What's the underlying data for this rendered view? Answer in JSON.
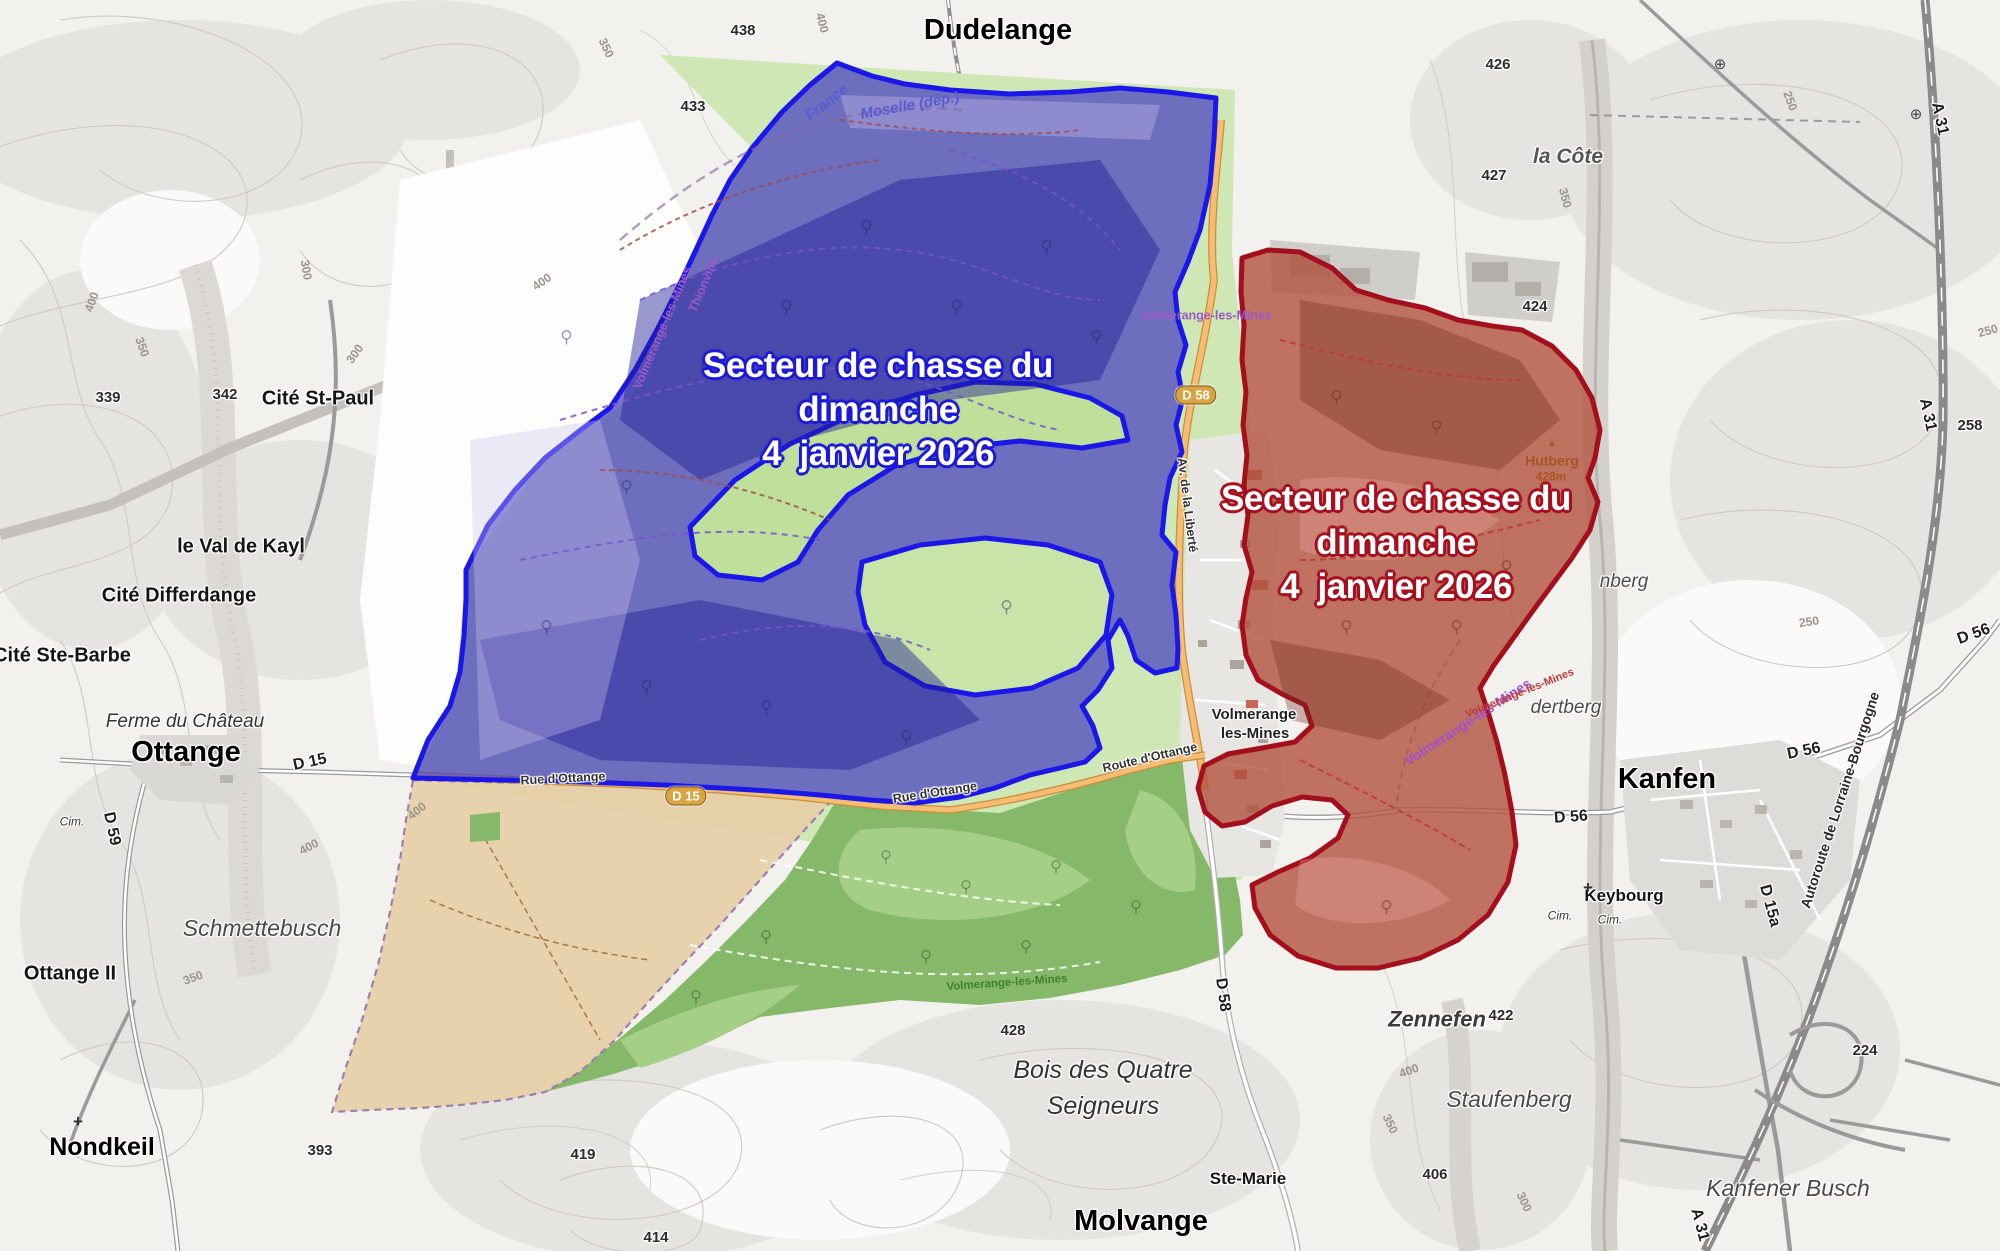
{
  "map_overlays": {
    "blue_sector": {
      "line1": "Secteur de chasse du",
      "line2": "dimanche",
      "line3": "4  janvier 2026",
      "outline_color": "#1d1ad6"
    },
    "red_sector": {
      "line1": "Secteur de chasse du",
      "line2": "dimanche",
      "line3": "4  janvier 2026",
      "outline_color": "#a50f1e"
    }
  },
  "zones": {
    "blue": {
      "fill": "#4a44c0",
      "border": "#1a17e8"
    },
    "red": {
      "fill": "#b2604f",
      "border": "#a30f1c"
    },
    "tan": {
      "fill": "#e7cfa9",
      "border": "#9b7fae"
    }
  },
  "map": {
    "labels": [
      {
        "text": "Dudelange",
        "x": 998,
        "y": 30,
        "kind": "town-xl halo",
        "name": "label-dudelange"
      },
      {
        "text": "Ottange",
        "x": 186,
        "y": 752,
        "kind": "town-xl halo",
        "name": "label-ottange"
      },
      {
        "text": "Molvange",
        "x": 1141,
        "y": 1221,
        "kind": "town-xl halo",
        "name": "label-molvange"
      },
      {
        "text": "Kanfen",
        "x": 1667,
        "y": 779,
        "kind": "town-xl halo",
        "name": "label-kanfen"
      },
      {
        "text": "Nondkeil",
        "x": 102,
        "y": 1147,
        "kind": "town-lg halo",
        "name": "label-nondkeil"
      },
      {
        "text": "Zennefen",
        "x": 1437,
        "y": 1019,
        "kind": "wood-b halo",
        "name": "label-zennefen"
      },
      {
        "text": "Volmerange",
        "x": 1254,
        "y": 715,
        "kind": "town-2l halo",
        "name": "label-volmerange-line1"
      },
      {
        "text": "les-Mines",
        "x": 1255,
        "y": 734,
        "kind": "town-2l halo",
        "name": "label-volmerange-line2"
      },
      {
        "text": "Cité St-Paul",
        "x": 318,
        "y": 399,
        "kind": "town-md halo",
        "name": "label-cite-st-paul"
      },
      {
        "text": "le Val de Kayl",
        "x": 241,
        "y": 547,
        "kind": "town-md halo",
        "name": "label-le-val-de-kayl"
      },
      {
        "text": "Cité Differdange",
        "x": 179,
        "y": 596,
        "kind": "town-md halo",
        "name": "label-cite-differdange"
      },
      {
        "text": "Cité Ste-Barbe",
        "x": 62,
        "y": 656,
        "kind": "town-md halo",
        "name": "label-cite-ste-barbe"
      },
      {
        "text": "Ottange II",
        "x": 70,
        "y": 974,
        "kind": "town-md halo",
        "name": "label-ottange-2"
      },
      {
        "text": "Ste-Marie",
        "x": 1248,
        "y": 1179,
        "kind": "town-sm halo",
        "name": "label-ste-marie"
      },
      {
        "text": "Keybourg",
        "x": 1624,
        "y": 896,
        "kind": "town-sm halo",
        "name": "label-keybourg"
      },
      {
        "text": "Ferme du Château",
        "x": 185,
        "y": 722,
        "kind": "farm halo",
        "name": "label-ferme-du-chateau"
      },
      {
        "text": "Schmettebusch",
        "x": 262,
        "y": 928,
        "kind": "wood halo",
        "name": "label-schmettebusch"
      },
      {
        "text": "Staufenberg",
        "x": 1509,
        "y": 1099,
        "kind": "wood halo",
        "name": "label-staufenberg"
      },
      {
        "text": "Kanfener Busch",
        "x": 1788,
        "y": 1188,
        "kind": "wood halo",
        "name": "label-kanfener-busch"
      },
      {
        "text": "Bois des Quatre",
        "x": 1103,
        "y": 1070,
        "kind": "wood-dk halo",
        "name": "label-bois-des-quatre"
      },
      {
        "text": "Seigneurs",
        "x": 1103,
        "y": 1106,
        "kind": "wood-dk halo",
        "name": "label-seigneurs"
      },
      {
        "text": "la Côte",
        "x": 1568,
        "y": 157,
        "kind": "hill halo",
        "name": "label-la-cote"
      },
      {
        "text": "dertberg",
        "x": 1566,
        "y": 708,
        "kind": "hill-sm halo",
        "name": "label-dertberg"
      },
      {
        "text": "nberg",
        "x": 1624,
        "y": 582,
        "kind": "hill-sm halo",
        "name": "label-nberg"
      },
      {
        "text": "Cim.",
        "x": 72,
        "y": 822,
        "kind": "cim halo",
        "name": "label-cimetiere"
      },
      {
        "text": "Cim.",
        "x": 1560,
        "y": 916,
        "kind": "cim halo",
        "name": "label-cimetiere"
      },
      {
        "text": "Cim.",
        "x": 1610,
        "y": 920,
        "kind": "cim halo",
        "name": "label-cimetiere"
      },
      {
        "text": "+",
        "x": 78,
        "y": 1122,
        "kind": "cross",
        "name": "cross-icon"
      },
      {
        "text": "+",
        "x": 1588,
        "y": 888,
        "kind": "cross",
        "name": "cross-icon"
      },
      {
        "text": "⊕",
        "x": 1720,
        "y": 65,
        "kind": "junction",
        "name": "junction-icon"
      },
      {
        "text": "⊕",
        "x": 1916,
        "y": 115,
        "kind": "junction",
        "name": "junction-icon"
      },
      {
        "text": "D 15",
        "x": 310,
        "y": 763,
        "rot": -12,
        "kind": "roadlbl halo",
        "name": "label-road-d15"
      },
      {
        "text": "D 59",
        "x": 111,
        "y": 829,
        "rot": 78,
        "kind": "roadlbl halo",
        "name": "label-road-d59"
      },
      {
        "text": "D 56",
        "x": 1571,
        "y": 818,
        "rot": -4,
        "kind": "roadlbl halo",
        "name": "label-road-d56"
      },
      {
        "text": "D 56",
        "x": 1804,
        "y": 752,
        "rot": -12,
        "kind": "roadlbl halo",
        "name": "label-road-d56"
      },
      {
        "text": "D 56",
        "x": 1974,
        "y": 635,
        "rot": -20,
        "kind": "roadlbl halo",
        "name": "label-road-d56"
      },
      {
        "text": "D 58",
        "x": 1222,
        "y": 995,
        "rot": 82,
        "kind": "roadlbl halo",
        "name": "label-road-d58"
      },
      {
        "text": "D 15a",
        "x": 1769,
        "y": 906,
        "rot": 75,
        "kind": "roadlbl halo",
        "name": "label-road-d15a"
      },
      {
        "text": "A 31",
        "x": 1939,
        "y": 119,
        "rot": 78,
        "kind": "roadlbl halo",
        "name": "label-road-a31"
      },
      {
        "text": "A 31",
        "x": 1927,
        "y": 415,
        "rot": 78,
        "kind": "roadlbl halo",
        "name": "label-road-a31"
      },
      {
        "text": "A 31",
        "x": 1699,
        "y": 1225,
        "rot": 75,
        "kind": "roadlbl halo",
        "name": "label-road-a31"
      },
      {
        "text": "258",
        "x": 1970,
        "y": 426,
        "kind": "elev halo",
        "name": "label-elev-258"
      },
      {
        "text": "224",
        "x": 1865,
        "y": 1051,
        "kind": "elev halo",
        "name": "label-elev-224"
      },
      {
        "text": "Autoroute de Lorraine-Bourgogne",
        "x": 1840,
        "y": 800,
        "rot": -72,
        "kind": "mwy halo",
        "name": "label-autoroute-lorraine-bourgogne"
      },
      {
        "text": "Route d'Ottange",
        "x": 1150,
        "y": 758,
        "rot": -13,
        "kind": "street halo",
        "name": "label-route-d-ottange"
      },
      {
        "text": "Rue d'Ottange",
        "x": 563,
        "y": 779,
        "rot": -3,
        "kind": "street halo",
        "name": "label-rue-d-ottange"
      },
      {
        "text": "Rue d'Ottange",
        "x": 935,
        "y": 793,
        "rot": -9,
        "kind": "street halo",
        "name": "label-rue-d-ottange"
      },
      {
        "text": "Av. de la Liberté",
        "x": 1187,
        "y": 505,
        "rot": 83,
        "kind": "street halo",
        "name": "label-av-de-la-liberte"
      },
      {
        "text": "D 15",
        "x": 686,
        "y": 796,
        "kind": "shield",
        "name": "road-shield-d15"
      },
      {
        "text": "D 58",
        "x": 1196,
        "y": 395,
        "kind": "shield",
        "name": "road-shield-d58"
      },
      {
        "text": "France",
        "x": 827,
        "y": 103,
        "rot": -38,
        "kind": "bnd-blue",
        "name": "label-border-france"
      },
      {
        "text": "Moselle (dép.)",
        "x": 910,
        "y": 106,
        "rot": -10,
        "kind": "bnd-blue",
        "name": "label-border-moselle"
      },
      {
        "text": "Volmerange-les-Mines",
        "x": 1206,
        "y": 316,
        "kind": "bnd-purple",
        "name": "label-commune-volmerange"
      },
      {
        "text": "Volmerange-les-Mines",
        "x": 663,
        "y": 328,
        "rot": -67,
        "kind": "bnd-purple",
        "name": "label-commune-volmerange"
      },
      {
        "text": "Thionville",
        "x": 704,
        "y": 285,
        "rot": -67,
        "kind": "bnd-purple",
        "name": "label-commune-thionville"
      },
      {
        "text": "Volmerange-les-Mines",
        "x": 1468,
        "y": 722,
        "rot": -33,
        "kind": "bnd-purple2",
        "name": "label-commune-volmerange"
      },
      {
        "text": "Volmerange-les-Mines",
        "x": 1520,
        "y": 694,
        "rot": -22,
        "kind": "bnd-red",
        "name": "label-commune-volmerange"
      },
      {
        "text": "Volmerange-les-Mines",
        "x": 1007,
        "y": 983,
        "rot": -4,
        "kind": "path-green",
        "name": "label-path-volmerange"
      },
      {
        "text": "Hutberg",
        "x": 1552,
        "y": 461,
        "kind": "hutberg",
        "name": "label-hutberg"
      },
      {
        "text": "428m",
        "x": 1551,
        "y": 477,
        "kind": "hutberg-m",
        "name": "label-hutberg-elevation"
      },
      {
        "text": "▲",
        "x": 1552,
        "y": 444,
        "kind": "peak",
        "name": "peak-icon"
      },
      {
        "text": "438",
        "x": 743,
        "y": 31,
        "kind": "elev halo",
        "name": "label-elev-438"
      },
      {
        "text": "433",
        "x": 693,
        "y": 107,
        "kind": "elev halo",
        "name": "label-elev-433"
      },
      {
        "text": "426",
        "x": 1498,
        "y": 65,
        "kind": "elev halo",
        "name": "label-elev-426"
      },
      {
        "text": "427",
        "x": 1494,
        "y": 176,
        "kind": "elev halo",
        "name": "label-elev-427"
      },
      {
        "text": "424",
        "x": 1535,
        "y": 307,
        "kind": "elev halo",
        "name": "label-elev-424"
      },
      {
        "text": "422",
        "x": 1501,
        "y": 1016,
        "kind": "elev halo",
        "name": "label-elev-422"
      },
      {
        "text": "406",
        "x": 1435,
        "y": 1175,
        "kind": "elev halo",
        "name": "label-elev-406"
      },
      {
        "text": "428",
        "x": 1013,
        "y": 1031,
        "kind": "elev halo",
        "name": "label-elev-428"
      },
      {
        "text": "419",
        "x": 583,
        "y": 1155,
        "kind": "elev halo",
        "name": "label-elev-419"
      },
      {
        "text": "414",
        "x": 656,
        "y": 1238,
        "kind": "elev halo",
        "name": "label-elev-414"
      },
      {
        "text": "393",
        "x": 320,
        "y": 1151,
        "kind": "elev halo",
        "name": "label-elev-393"
      },
      {
        "text": "339",
        "x": 108,
        "y": 398,
        "kind": "elev halo",
        "name": "label-elev-339"
      },
      {
        "text": "342",
        "x": 225,
        "y": 395,
        "kind": "elev halo",
        "name": "label-elev-342"
      },
      {
        "text": "350",
        "x": 606,
        "y": 48,
        "rot": 65,
        "kind": "contour",
        "name": "label-contour-350"
      },
      {
        "text": "400",
        "x": 822,
        "y": 23,
        "rot": 75,
        "kind": "contour",
        "name": "label-contour-400"
      },
      {
        "text": "400",
        "x": 92,
        "y": 302,
        "rot": -70,
        "kind": "contour",
        "name": "label-contour-400"
      },
      {
        "text": "350",
        "x": 142,
        "y": 347,
        "rot": 70,
        "kind": "contour",
        "name": "label-contour-350"
      },
      {
        "text": "300",
        "x": 306,
        "y": 270,
        "rot": 80,
        "kind": "contour",
        "name": "label-contour-300"
      },
      {
        "text": "300",
        "x": 355,
        "y": 354,
        "rot": -55,
        "kind": "contour",
        "name": "label-contour-300"
      },
      {
        "text": "400",
        "x": 542,
        "y": 282,
        "rot": -35,
        "kind": "contour",
        "name": "label-contour-400"
      },
      {
        "text": "400",
        "x": 309,
        "y": 847,
        "rot": -28,
        "kind": "contour",
        "name": "label-contour-400"
      },
      {
        "text": "400",
        "x": 417,
        "y": 811,
        "rot": -38,
        "kind": "contour",
        "name": "label-contour-400"
      },
      {
        "text": "350",
        "x": 193,
        "y": 978,
        "rot": -20,
        "kind": "contour",
        "name": "label-contour-350"
      },
      {
        "text": "350",
        "x": 1565,
        "y": 198,
        "rot": 75,
        "kind": "contour",
        "name": "label-contour-350"
      },
      {
        "text": "250",
        "x": 1790,
        "y": 101,
        "rot": 70,
        "kind": "contour",
        "name": "label-contour-250"
      },
      {
        "text": "250",
        "x": 1988,
        "y": 331,
        "rot": -15,
        "kind": "contour",
        "name": "label-contour-250"
      },
      {
        "text": "250",
        "x": 1809,
        "y": 622,
        "rot": -8,
        "kind": "contour",
        "name": "label-contour-250"
      },
      {
        "text": "350",
        "x": 1390,
        "y": 1124,
        "rot": 65,
        "kind": "contour",
        "name": "label-contour-350"
      },
      {
        "text": "400",
        "x": 1409,
        "y": 1071,
        "rot": -20,
        "kind": "contour",
        "name": "label-contour-400"
      },
      {
        "text": "300",
        "x": 1524,
        "y": 1202,
        "rot": 65,
        "kind": "contour",
        "name": "label-contour-300"
      }
    ]
  }
}
